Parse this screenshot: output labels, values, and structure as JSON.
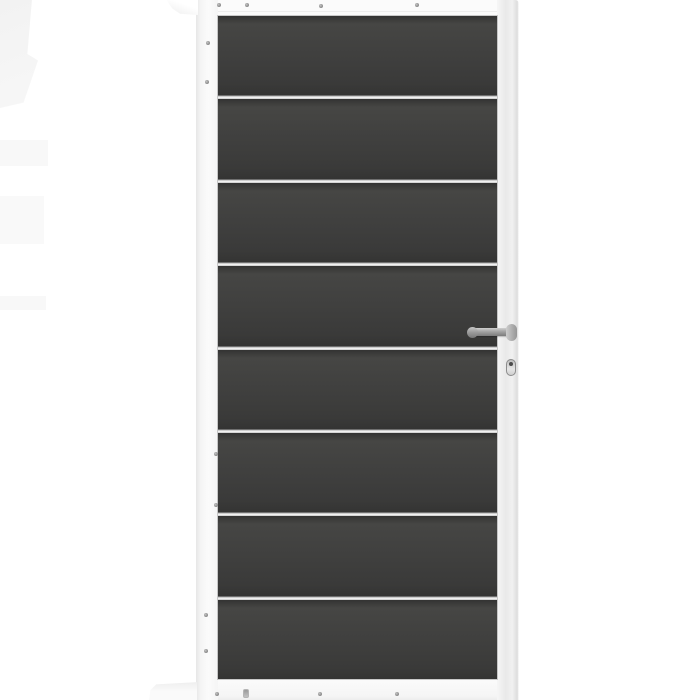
{
  "colors": {
    "background": "#ffffff",
    "frame_white": "#fbfbfb",
    "frame_shade": "#e6e6e6",
    "panel_dark": "#3f3f3e",
    "panel_darker": "#343433",
    "panel_light": "#464644",
    "separator_silver": "#f0f0f0",
    "separator_shadow": "#6f6f6f",
    "metal_light": "#cfcfcf",
    "metal_dark": "#7c7c7c",
    "screw_gray": "#8a8a8a",
    "artifact_gray": "#f2f2f2"
  },
  "gate": {
    "panel_count": 8,
    "separator_count": 7,
    "hardware": {
      "handle": "lever-handle",
      "lock": "profile-cylinder"
    },
    "screws": [
      {
        "x": 217,
        "y": 3,
        "type": "round"
      },
      {
        "x": 245,
        "y": 3,
        "type": "round"
      },
      {
        "x": 319,
        "y": 4,
        "type": "round"
      },
      {
        "x": 415,
        "y": 3,
        "type": "round"
      },
      {
        "x": 206,
        "y": 41,
        "type": "round"
      },
      {
        "x": 205,
        "y": 80,
        "type": "round"
      },
      {
        "x": 214,
        "y": 452,
        "type": "round"
      },
      {
        "x": 214,
        "y": 503,
        "type": "round"
      },
      {
        "x": 204,
        "y": 613,
        "type": "round"
      },
      {
        "x": 204,
        "y": 649,
        "type": "round"
      },
      {
        "x": 215,
        "y": 692,
        "type": "round"
      },
      {
        "x": 243,
        "y": 689,
        "type": "slot"
      },
      {
        "x": 318,
        "y": 692,
        "type": "round"
      },
      {
        "x": 395,
        "y": 692,
        "type": "round"
      }
    ]
  }
}
